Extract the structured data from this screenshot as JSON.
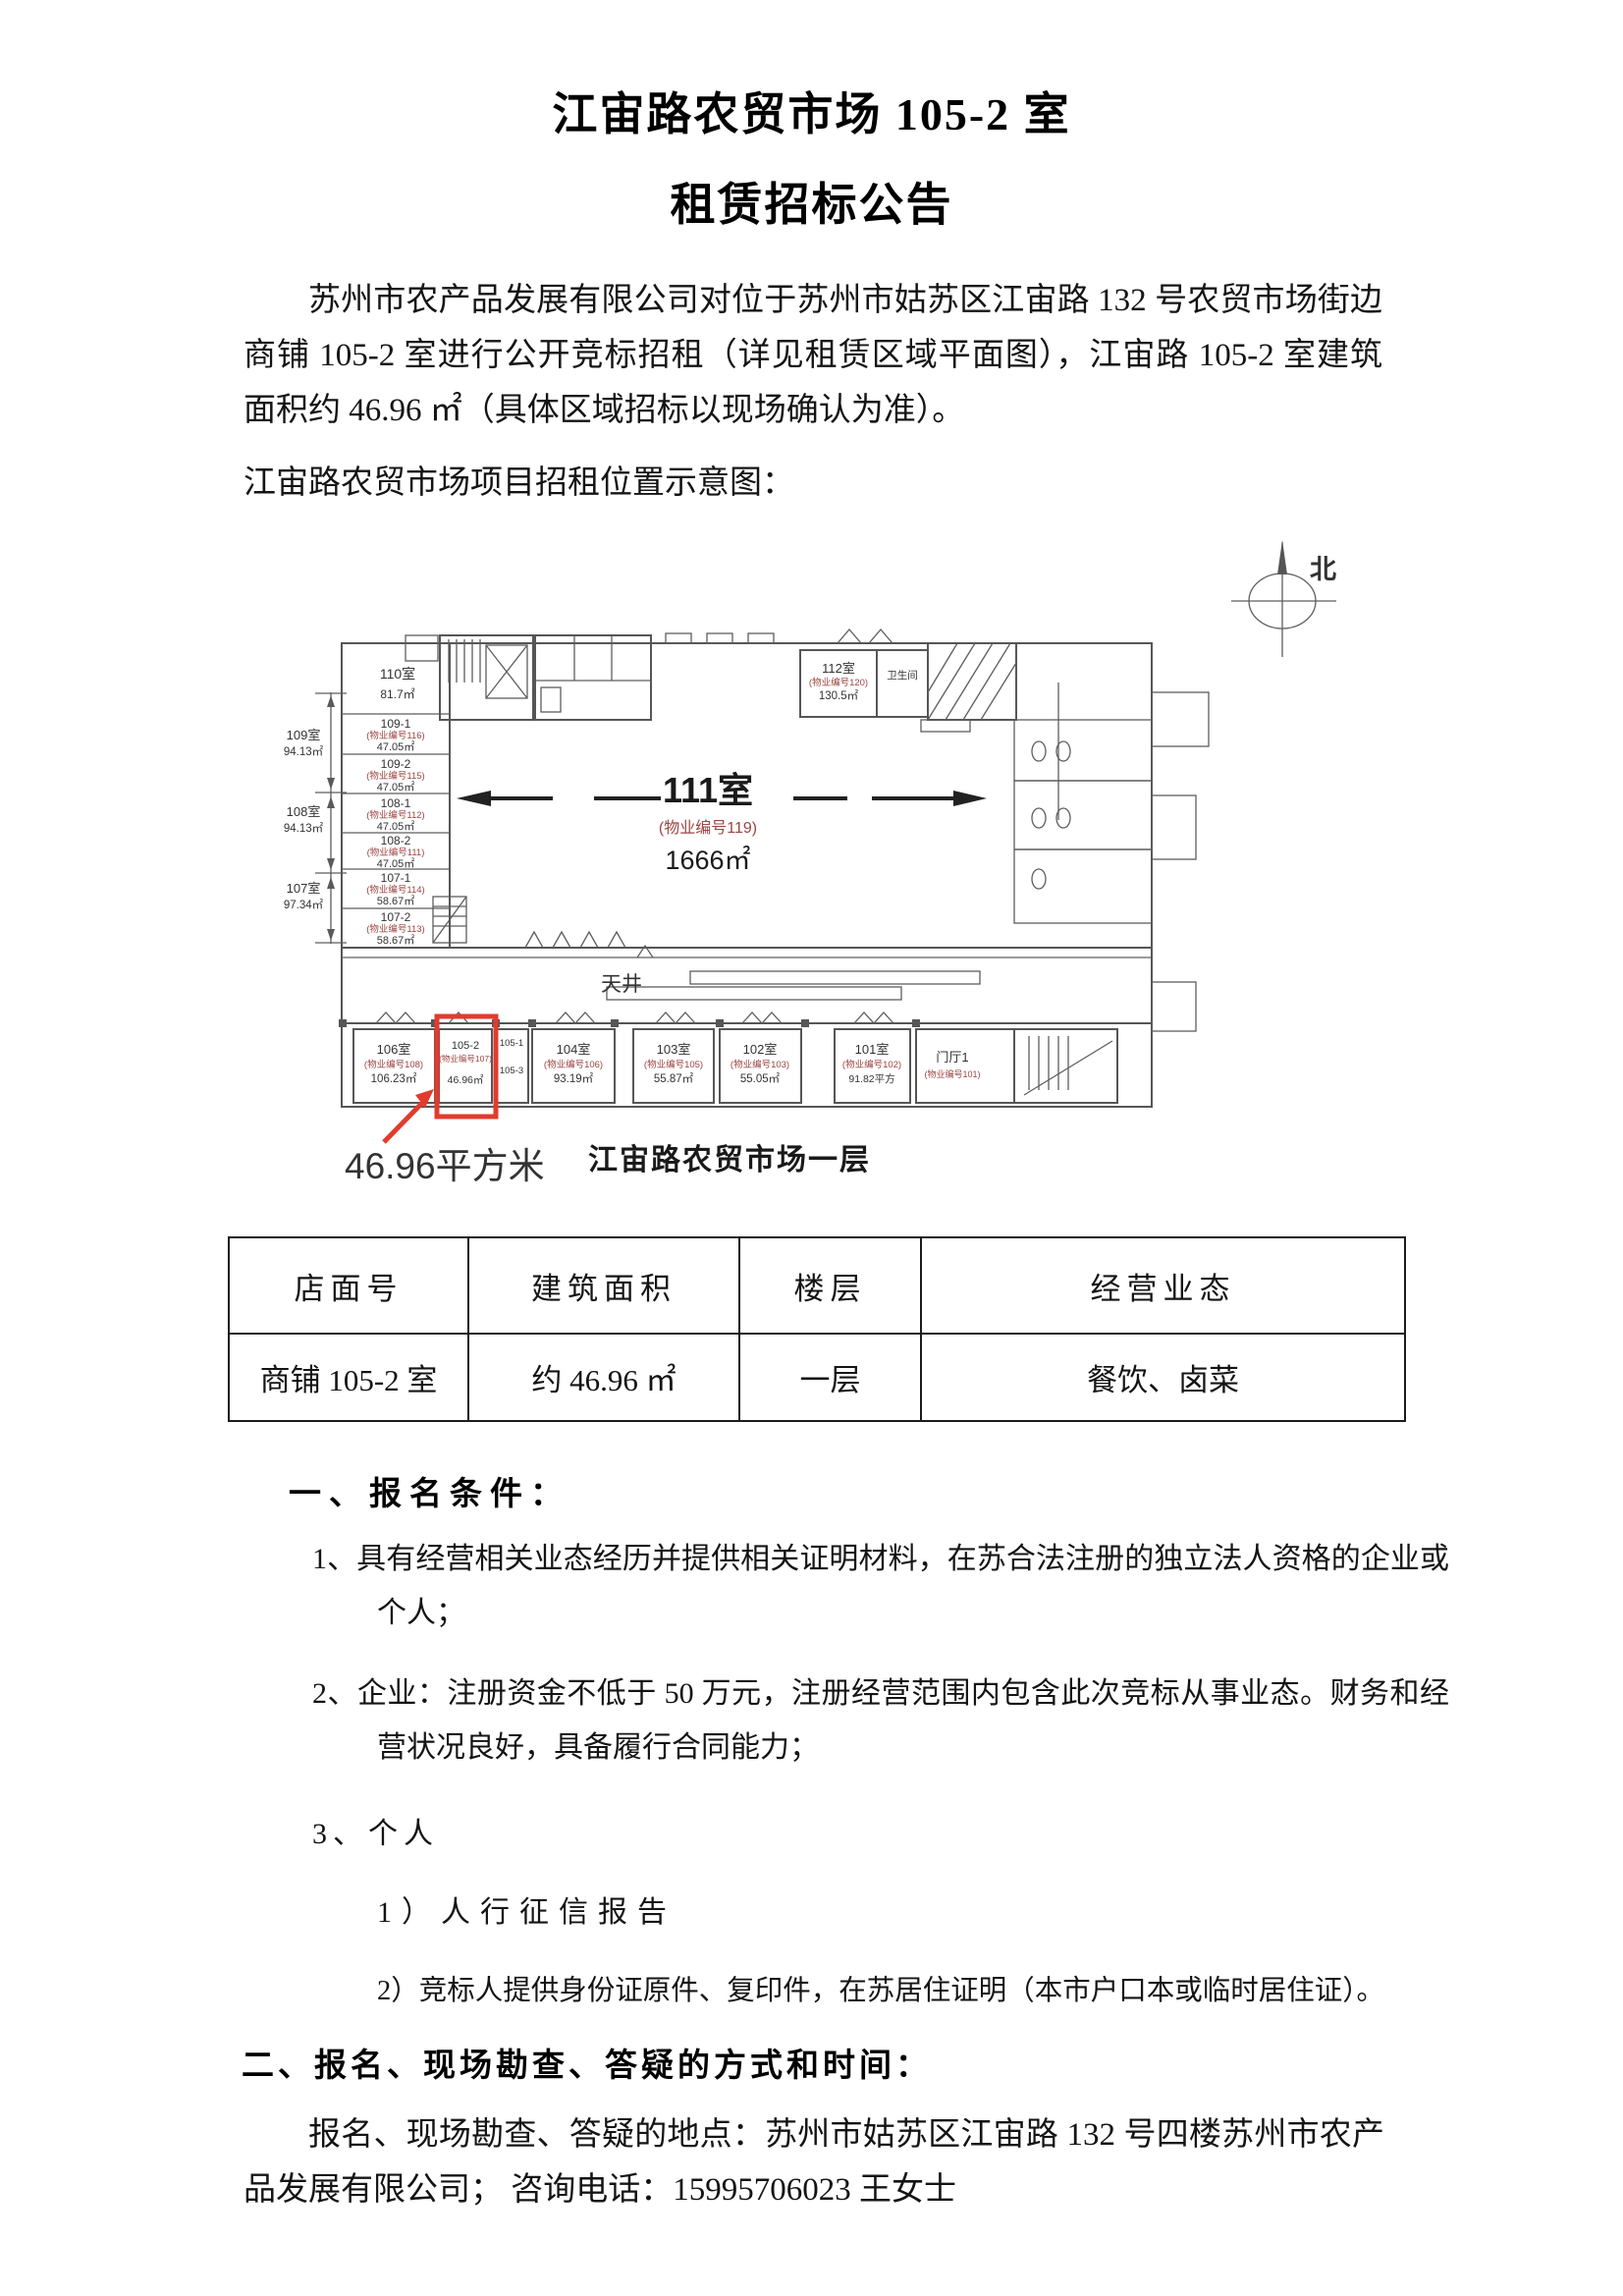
{
  "document": {
    "title_line1": "江宙路农贸市场 105-2 室",
    "title_line2": "租赁招标公告",
    "intro_paragraph": "苏州市农产品发展有限公司对位于苏州市姑苏区江宙路 132 号农贸市场街边商铺 105-2 室进行公开竞标招租（详见租赁区域平面图），江宙路 105-2 室建筑面积约 46.96 ㎡（具体区域招标以现场确认为准）。",
    "figure_intro": "江宙路农贸市场项目招租位置示意图："
  },
  "floor_plan": {
    "compass": "北",
    "caption": "江宙路农贸市场一层",
    "highlight_label": "46.96平方米",
    "courtyard_label": "天井",
    "hall": {
      "name": "111室",
      "code": "(物业编号119)",
      "area": "1666㎡"
    },
    "room_110": {
      "name": "110室",
      "area": "81.7㎡"
    },
    "room_112": {
      "name": "112室",
      "code": "(物业编号120)",
      "area": "130.5㎡"
    },
    "room_wc": {
      "name": "卫生间"
    },
    "left_rooms": [
      {
        "name": "109-1",
        "code": "(物业编号116)",
        "area": "47.05㎡"
      },
      {
        "name": "109-2",
        "code": "(物业编号115)",
        "area": "47.05㎡"
      },
      {
        "name": "108-1",
        "code": "(物业编号112)",
        "area": "47.05㎡"
      },
      {
        "name": "108-2",
        "code": "(物业编号111)",
        "area": "47.05㎡"
      },
      {
        "name": "107-1",
        "code": "(物业编号114)",
        "area": "58.67㎡"
      },
      {
        "name": "107-2",
        "code": "(物业编号113)",
        "area": "58.67㎡"
      }
    ],
    "side_dims": [
      {
        "name": "109室",
        "area": "94.13㎡"
      },
      {
        "name": "108室",
        "area": "94.13㎡"
      },
      {
        "name": "107室",
        "area": "97.34㎡"
      }
    ],
    "bottom_rooms": [
      {
        "name": "106室",
        "code": "(物业编号108)",
        "area": "106.23㎡"
      },
      {
        "name": "104室",
        "code": "(物业编号106)",
        "area": "93.19㎡"
      },
      {
        "name": "103室",
        "code": "(物业编号105)",
        "area": "55.87㎡"
      },
      {
        "name": "102室",
        "code": "(物业编号103)",
        "area": "55.05㎡"
      },
      {
        "name": "101室",
        "code": "(物业编号102)",
        "area": "91.82平方"
      }
    ],
    "room_105_2": {
      "name": "105-2",
      "code": "(物业编号107)",
      "area": "46.96㎡"
    },
    "room_105_1": {
      "name": "105-1"
    },
    "room_105_3": {
      "name": "105-3"
    },
    "lobby": {
      "name": "门厅1",
      "code": "(物业编号101)"
    }
  },
  "table": {
    "headers": [
      "店面号",
      "建筑面积",
      "楼层",
      "经营业态"
    ],
    "row": [
      "商铺 105-2 室",
      "约 46.96 ㎡",
      "一层",
      "餐饮、卤菜"
    ]
  },
  "sections": {
    "s1_title": "一、报名条件：",
    "s1_item1": "1、具有经营相关业态经历并提供相关证明材料，在苏合法注册的独立法人资格的企业或个人；",
    "s1_item2": "2、企业：注册资金不低于 50 万元，注册经营范围内包含此次竞标从事业态。财务和经营状况良好，具备履行合同能力；",
    "s1_item3": "3、个人",
    "s1_sub1": "1）人行征信报告",
    "s1_sub2": "2）竞标人提供身份证原件、复印件，在苏居住证明（本市户口本或临时居住证）。",
    "s2_title": "二、报名、现场勘查、答疑的方式和时间：",
    "s2_body": "报名、现场勘查、答疑的地点：苏州市姑苏区江宙路 132 号四楼苏州市农产品发展有限公司；  咨询电话：15995706023 王女士"
  },
  "colors": {
    "highlight_red": "#e23b2e",
    "plan_code_red": "#9c4542"
  }
}
